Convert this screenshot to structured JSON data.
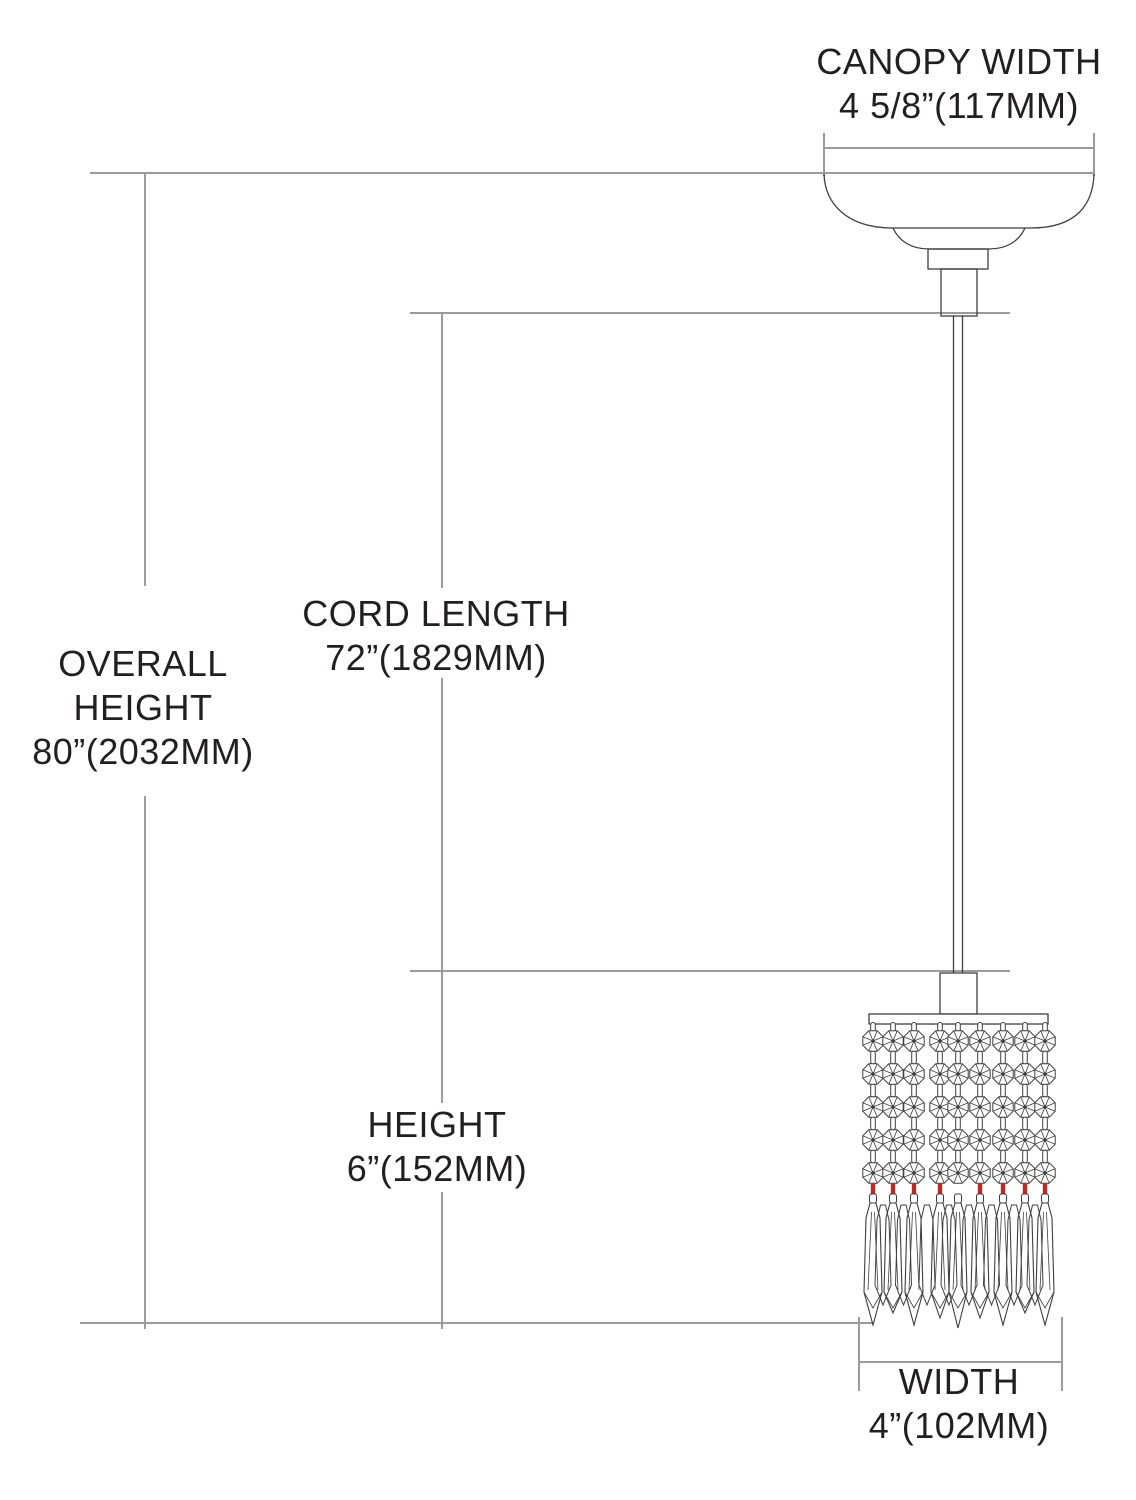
{
  "diagram": {
    "title": "pendant-light-dimension-drawing",
    "labels": {
      "canopy_width": {
        "title": "CANOPY WIDTH",
        "value": "4 5/8”(117MM)"
      },
      "overall_height": {
        "title_line1": "OVERALL",
        "title_line2": "HEIGHT",
        "value": "80”(2032MM)"
      },
      "cord_length": {
        "title": "CORD LENGTH",
        "value": "72”(1829MM)"
      },
      "height": {
        "title": "HEIGHT",
        "value": "6”(152MM)"
      },
      "width": {
        "title": "WIDTH",
        "value": "4”(102MM)"
      }
    },
    "colors": {
      "background": "#ffffff",
      "drawing_line": "#3f3f3f",
      "dimension_line": "#9b9b9b",
      "text": "#231f20",
      "crystal_pin_red": "#bb2b25"
    }
  }
}
